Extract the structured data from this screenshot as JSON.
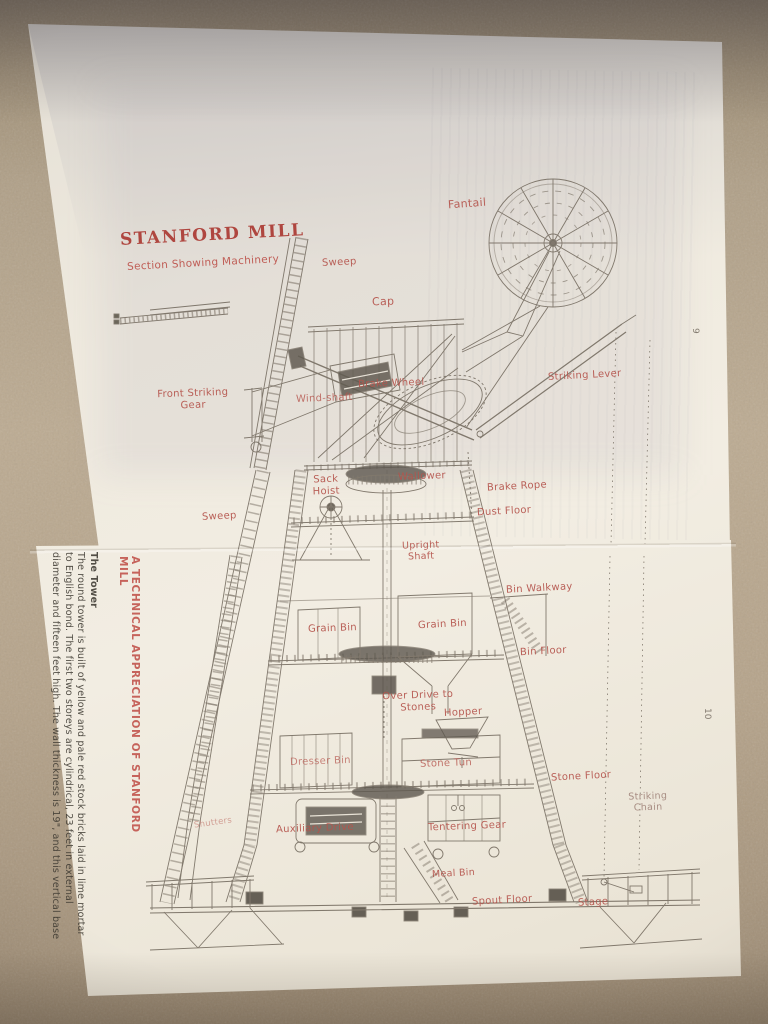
{
  "page": {
    "title": "STANFORD MILL",
    "subtitle": "Section Showing Machinery",
    "page_number_top": "9",
    "page_number_bottom": "10"
  },
  "labels": {
    "fantail": "Fantail",
    "sweep_top": "Sweep",
    "cap": "Cap",
    "brake_wheel": "Brake Wheel",
    "striking_lever": "Striking Lever",
    "front_striking_gear": "Front Striking Gear",
    "wind_shaft": "Wind-shaft",
    "sack_hoist": "Sack Hoist",
    "wallower": "Wallower",
    "brake_rope": "Brake Rope",
    "dust_floor": "Dust Floor",
    "sweep_left": "Sweep",
    "upright_shaft": "Upright Shaft",
    "bin_walkway": "Bin Walkway",
    "grain_bin_left": "Grain Bin",
    "grain_bin_right": "Grain Bin",
    "bin_floor": "Bin Floor",
    "over_drive": "Over Drive to Stones",
    "hopper": "Hopper",
    "dresser_bin": "Dresser Bin",
    "stone_tun": "Stone Tun",
    "stone_floor": "Stone Floor",
    "striking_chain": "Striking Chain",
    "shutters": "Shutters",
    "auxiliary_drive": "Auxiliary Drive",
    "tentering_gear": "Tentering Gear",
    "meal_bin": "Meal Bin",
    "spout_floor": "Spout Floor",
    "stage": "Stage"
  },
  "sidebar_text": {
    "heading": "A TECHNICAL APPRECIATION OF STANFORD MILL",
    "tower_heading": "The Tower",
    "tower_body": "The round tower is built of yellow and pale red stock bricks laid in lime mortar to English bond. The first two storeys are cylindrical, 23 feet in external diameter and fifteen feet high. The wall thickness is 19\", and this vertical base"
  },
  "colors": {
    "label_red": "#b5544c",
    "title_red": "#ab3a33",
    "ink": "#6f665a",
    "paper": "#efeadf",
    "carpet": "#b2a189"
  }
}
